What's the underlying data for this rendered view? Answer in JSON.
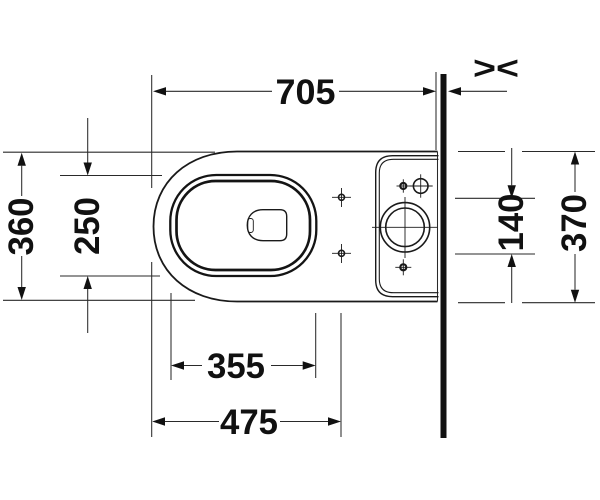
{
  "drawing": {
    "type": "technical-dimension-drawing",
    "subject": "floorstanding-toilet-with-cistern-top-view",
    "unit": "mm",
    "colors": {
      "ink": "#1a1a1a",
      "background": "#ffffff"
    }
  },
  "dims": {
    "total_depth": "705",
    "body_width": "360",
    "bowl_inner_width": "250",
    "seat_hole_spacing": "140",
    "tank_width": "370",
    "bowl_inner_length": "355",
    "bowl_front_length": "475",
    "wall_gap_marker": "><"
  }
}
